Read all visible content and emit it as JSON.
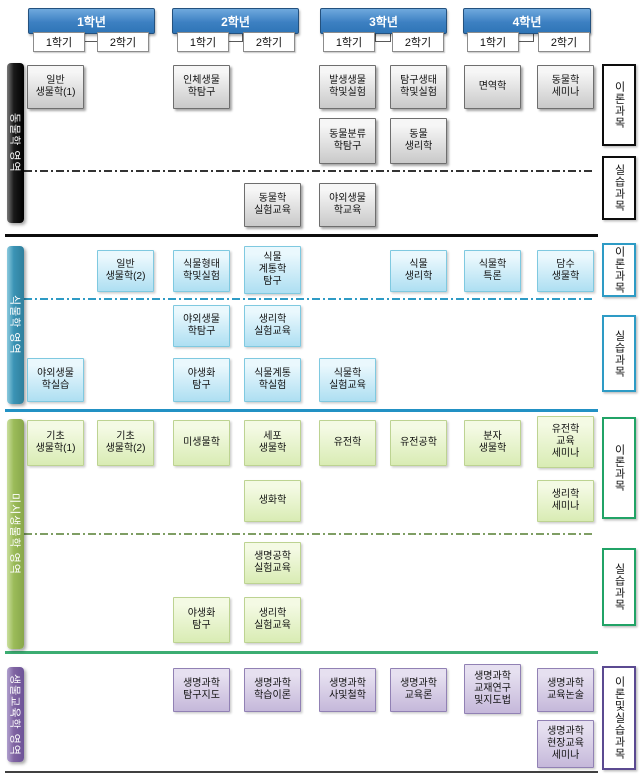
{
  "years": [
    {
      "label": "1학년",
      "semesters": [
        "1학기",
        "2학기"
      ]
    },
    {
      "label": "2학년",
      "semesters": [
        "1학기",
        "2학기"
      ]
    },
    {
      "label": "3학년",
      "semesters": [
        "1학기",
        "2학기"
      ]
    },
    {
      "label": "4학년",
      "semesters": [
        "1학기",
        "2학기"
      ]
    }
  ],
  "sections": [
    {
      "id": "zoology",
      "bar_label": "동물학 영역",
      "theme": "black",
      "right_labels": [
        "이론과목",
        "실습과목"
      ]
    },
    {
      "id": "botany",
      "bar_label": "식물학 영역",
      "theme": "teal",
      "right_labels": [
        "이론과목",
        "실습과목"
      ]
    },
    {
      "id": "micro",
      "bar_label": "미시생물학 영역",
      "theme": "green",
      "right_labels": [
        "이론과목",
        "실습과목"
      ]
    },
    {
      "id": "education",
      "bar_label": "생물교육학 영역",
      "theme": "purple",
      "right_labels": [
        "이론및실습과목"
      ]
    }
  ],
  "courses": [
    {
      "section": 0,
      "row": "z1",
      "col": 0,
      "label": "일반\n생물학(1)"
    },
    {
      "section": 0,
      "row": "z1",
      "col": 2,
      "label": "인체생물\n학탐구"
    },
    {
      "section": 0,
      "row": "z1",
      "col": 4,
      "label": "발생생물\n학및실험"
    },
    {
      "section": 0,
      "row": "z1",
      "col": 5,
      "label": "탐구생태\n학및실험"
    },
    {
      "section": 0,
      "row": "z1",
      "col": 6,
      "label": "면역학"
    },
    {
      "section": 0,
      "row": "z1",
      "col": 7,
      "label": "동물학\n세미나"
    },
    {
      "section": 0,
      "row": "z2",
      "col": 4,
      "label": "동물분류\n학탐구"
    },
    {
      "section": 0,
      "row": "z2",
      "col": 5,
      "label": "동물\n생리학"
    },
    {
      "section": 0,
      "row": "z3",
      "col": 3,
      "label": "동물학\n실험교육"
    },
    {
      "section": 0,
      "row": "z3",
      "col": 4,
      "label": "야외생물\n학교육"
    },
    {
      "section": 1,
      "row": "b1",
      "col": 1,
      "label": "일반\n생물학(2)"
    },
    {
      "section": 1,
      "row": "b1",
      "col": 2,
      "label": "식물형태\n학및실험"
    },
    {
      "section": 1,
      "row": "b1",
      "col": 3,
      "label": "식물\n계통학\n탐구",
      "lines": 3
    },
    {
      "section": 1,
      "row": "b1",
      "col": 5,
      "label": "식물\n생리학"
    },
    {
      "section": 1,
      "row": "b1",
      "col": 6,
      "label": "식물학\n특론"
    },
    {
      "section": 1,
      "row": "b1",
      "col": 7,
      "label": "담수\n생물학"
    },
    {
      "section": 1,
      "row": "b2",
      "col": 2,
      "label": "야외생물\n학탐구"
    },
    {
      "section": 1,
      "row": "b2",
      "col": 3,
      "label": "생리학\n실험교육"
    },
    {
      "section": 1,
      "row": "b3",
      "col": 0,
      "label": "야외생물\n학실습"
    },
    {
      "section": 1,
      "row": "b3",
      "col": 2,
      "label": "야생화\n탐구"
    },
    {
      "section": 1,
      "row": "b3",
      "col": 3,
      "label": "식물계통\n학실험"
    },
    {
      "section": 1,
      "row": "b3",
      "col": 4,
      "label": "식물학\n실험교육"
    },
    {
      "section": 2,
      "row": "g1",
      "col": 0,
      "label": "기초\n생물학(1)"
    },
    {
      "section": 2,
      "row": "g1",
      "col": 1,
      "label": "기초\n생물학(2)"
    },
    {
      "section": 2,
      "row": "g1",
      "col": 2,
      "label": "미생물학"
    },
    {
      "section": 2,
      "row": "g1",
      "col": 3,
      "label": "세포\n생물학"
    },
    {
      "section": 2,
      "row": "g1",
      "col": 4,
      "label": "유전학"
    },
    {
      "section": 2,
      "row": "g1",
      "col": 5,
      "label": "유전공학"
    },
    {
      "section": 2,
      "row": "g1",
      "col": 6,
      "label": "분자\n생물학"
    },
    {
      "section": 2,
      "row": "g1",
      "col": 7,
      "label": "유전학\n교육\n세미나",
      "lines": 3
    },
    {
      "section": 2,
      "row": "g2",
      "col": 3,
      "label": "생화학"
    },
    {
      "section": 2,
      "row": "g2",
      "col": 7,
      "label": "생리학\n세미나"
    },
    {
      "section": 2,
      "row": "g3",
      "col": 3,
      "label": "생명공학\n실험교육"
    },
    {
      "section": 2,
      "row": "g4",
      "col": 2,
      "label": "야생화\n탐구"
    },
    {
      "section": 2,
      "row": "g4",
      "col": 3,
      "label": "생리학\n실험교육"
    },
    {
      "section": 3,
      "row": "p1",
      "col": 2,
      "label": "생명과학\n탐구지도"
    },
    {
      "section": 3,
      "row": "p1",
      "col": 3,
      "label": "생명과학\n학습이론"
    },
    {
      "section": 3,
      "row": "p1",
      "col": 4,
      "label": "생명과학\n사및철학"
    },
    {
      "section": 3,
      "row": "p1",
      "col": 5,
      "label": "생명과학\n교육론"
    },
    {
      "section": 3,
      "row": "p1",
      "col": 6,
      "label": "생명과학\n교재연구\n및지도법",
      "lines": 3
    },
    {
      "section": 3,
      "row": "p1",
      "col": 7,
      "label": "생명과학\n교육논술"
    },
    {
      "section": 3,
      "row": "p2",
      "col": 7,
      "label": "생명과학\n현장교육\n세미나",
      "lines": 3
    }
  ],
  "colors": {
    "year_header_top": "#6fa9dd",
    "year_header_bottom": "#2e75b6",
    "year_header_border": "#24517e",
    "zoology_bar": "#000000",
    "zoology_box": "#d9d9d9",
    "botany_bar": "#31859c",
    "botany_box": "#bfe7f5",
    "micro_bar": "#9bbb59",
    "micro_box": "#e2efc9",
    "education_bar": "#8064a2",
    "education_box": "#ccc1dd",
    "divider_zoology_dash": "#333333",
    "divider_botany_dash": "#2e9bc5",
    "divider_micro_dash": "#7f9e64",
    "separator_black": "#0d0d0d",
    "separator_blue": "#2291c4",
    "separator_green": "#3cad72",
    "separator_bottom": "#404040"
  }
}
